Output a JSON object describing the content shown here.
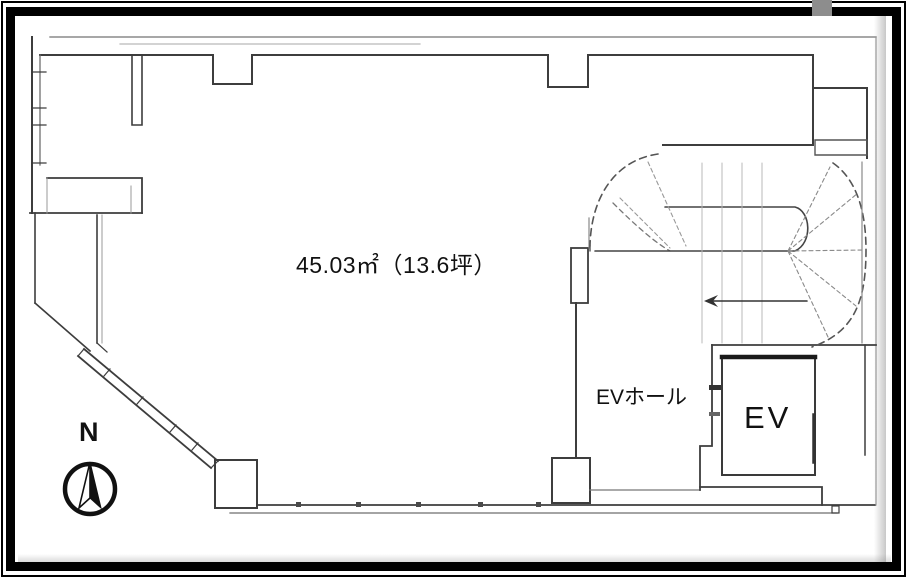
{
  "floor_plan": {
    "area_label": "45.03㎡（13.6坪）",
    "ev_hall_label": "EVホール",
    "elevator_label": "EV",
    "compass": {
      "north_label": "N"
    },
    "colors": {
      "wall_line": "#3d3d3d",
      "frame": "#000000",
      "scan_tab": "#8d8d8d",
      "background": "#ffffff"
    }
  }
}
